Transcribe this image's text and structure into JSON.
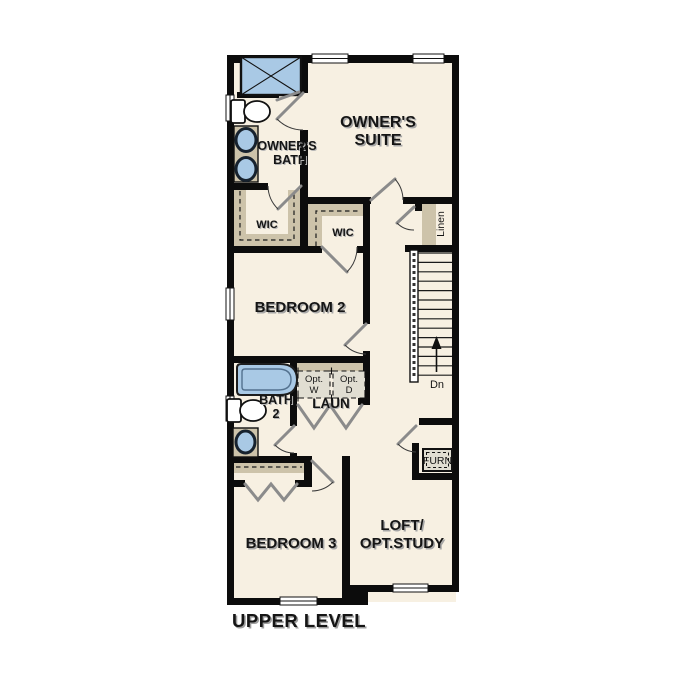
{
  "title": {
    "label": "UPPER LEVEL"
  },
  "colors": {
    "floor": "#f7f0e2",
    "wall": "#0c0c0c",
    "fixture_blue": "#a9c9e5",
    "shelf_tan": "#cdc3aa",
    "opt_box": "#e1ded2",
    "door_gray": "#8b8b8b"
  },
  "rooms": {
    "owners_suite": {
      "line1": "OWNER'S",
      "line2": "SUITE"
    },
    "owners_bath": {
      "line1": "OWNER'S",
      "line2": "BATH"
    },
    "wic_owner": {
      "label": "WIC"
    },
    "wic_bedroom2": {
      "label": "WIC"
    },
    "linen": {
      "label": "Linen"
    },
    "bedroom2": {
      "label": "BEDROOM 2"
    },
    "bath2": {
      "line1": "BATH",
      "line2": "2"
    },
    "laundry": {
      "label": "LAUN"
    },
    "opt_washer": {
      "line1": "Opt.",
      "line2": "W"
    },
    "opt_dryer": {
      "line1": "Opt.",
      "line2": "D"
    },
    "bedroom3": {
      "label": "BEDROOM 3"
    },
    "loft": {
      "line1": "LOFT/",
      "line2": "OPT.STUDY"
    },
    "furnace": {
      "label": "FURN"
    },
    "stairs": {
      "label": "Dn"
    }
  }
}
